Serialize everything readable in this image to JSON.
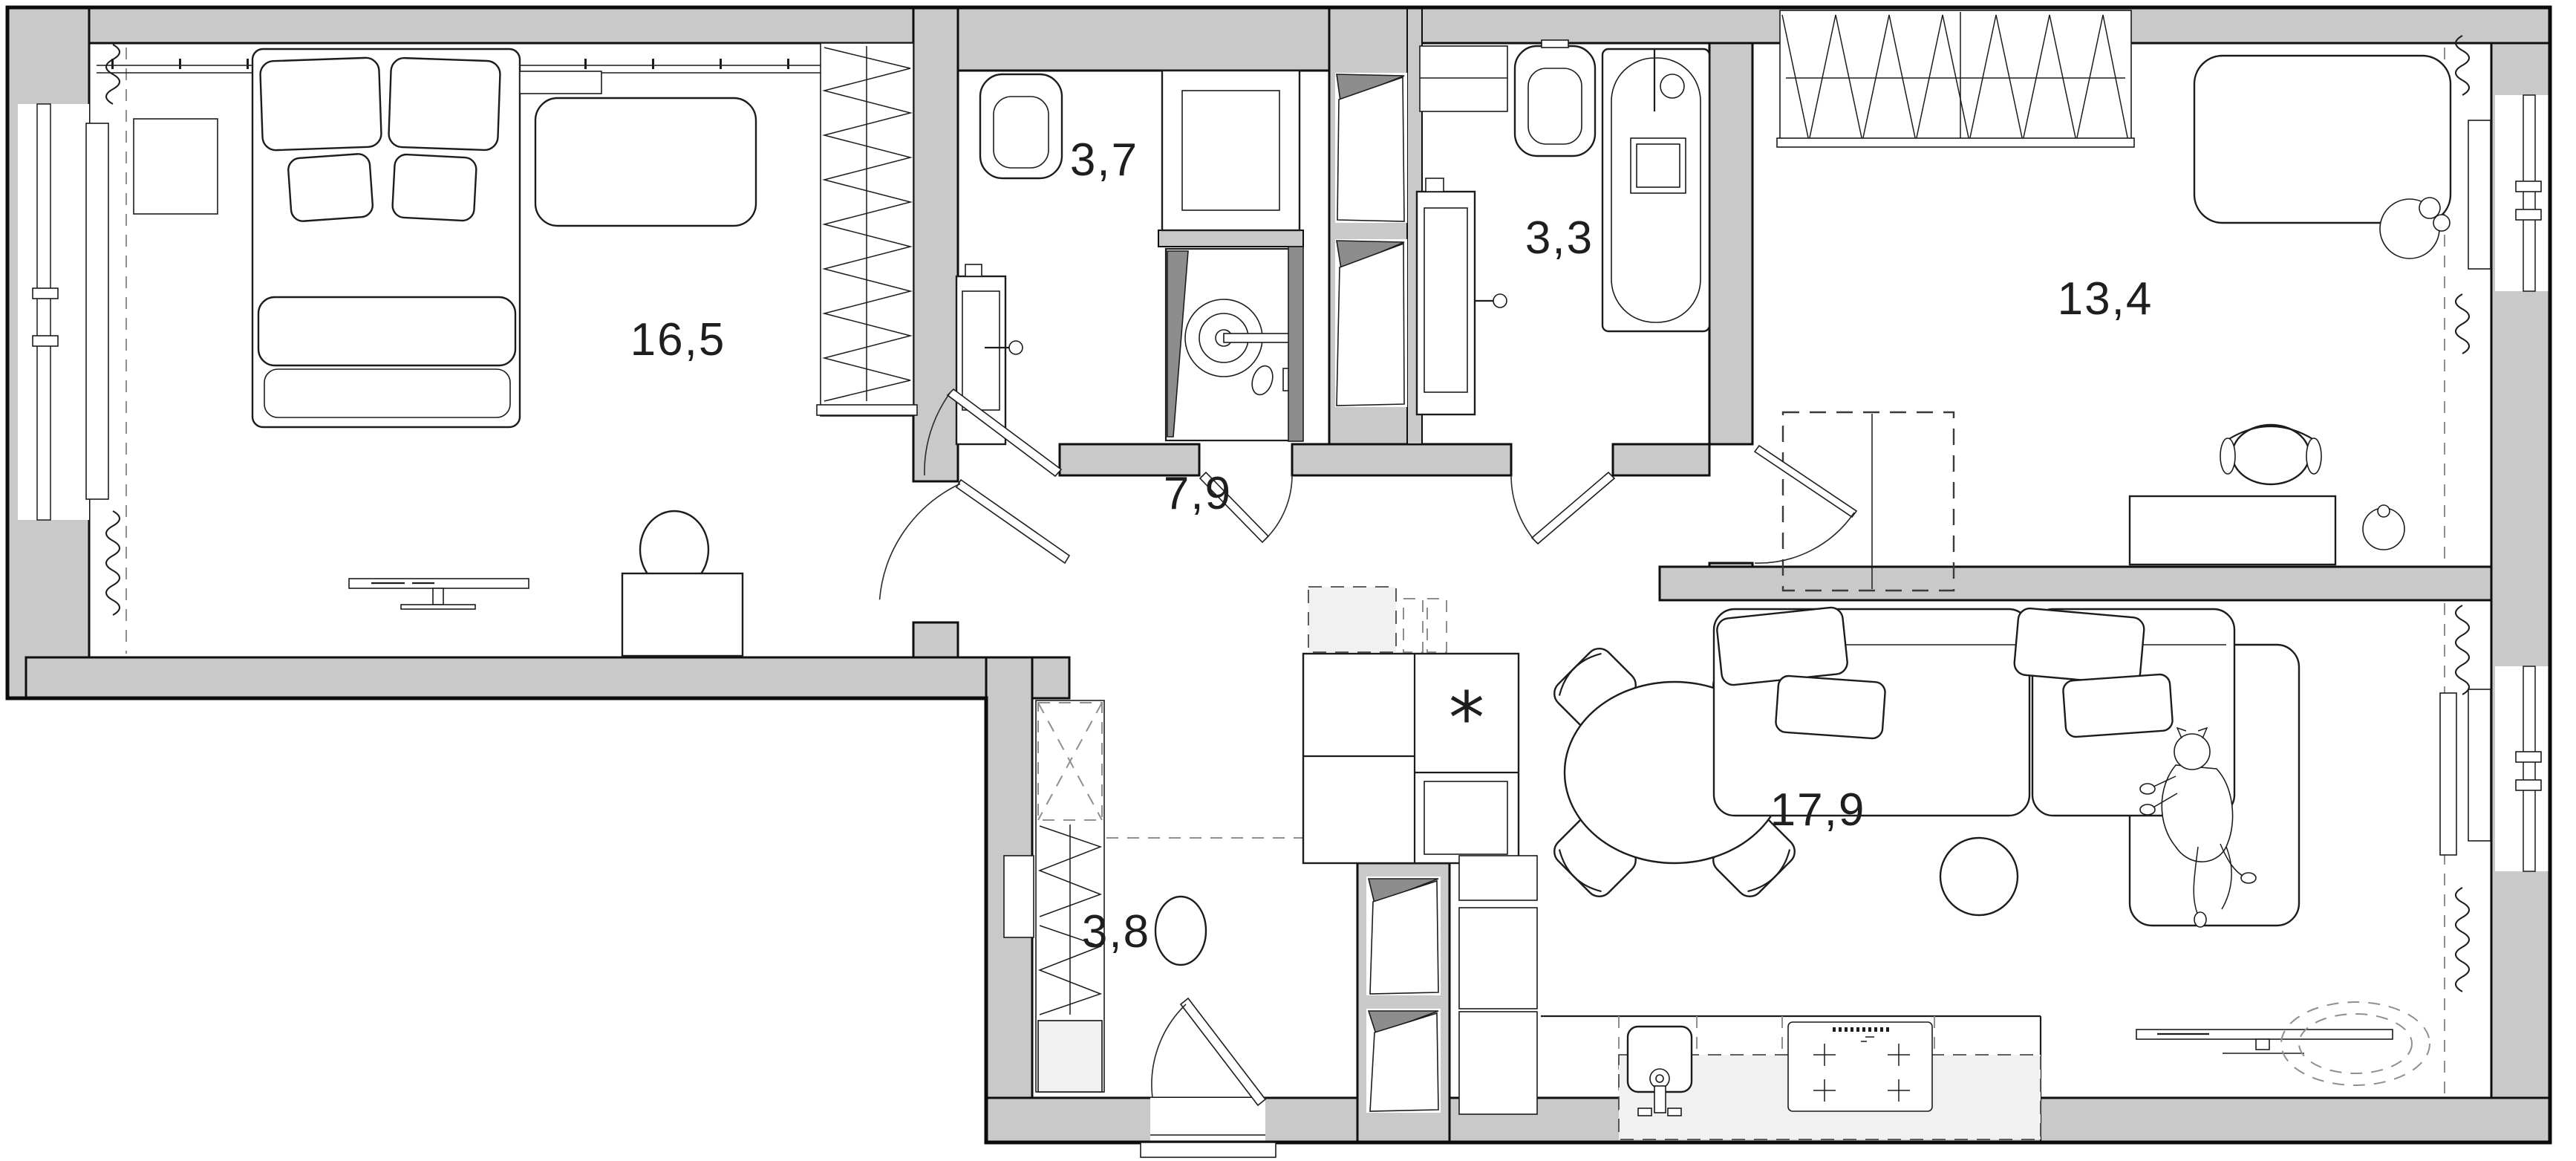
{
  "plan": {
    "type": "apartment-floor-plan",
    "rooms": [
      {
        "name": "bedroom",
        "area": "16,5"
      },
      {
        "name": "bathroom-shower",
        "area": "3,7"
      },
      {
        "name": "bathroom-tub",
        "area": "3,3"
      },
      {
        "name": "room-study",
        "area": "13,4"
      },
      {
        "name": "hallway",
        "area": "7,9"
      },
      {
        "name": "entry-corridor",
        "area": "3,8"
      },
      {
        "name": "living-kitchen",
        "area": "17,9"
      }
    ],
    "symbols": {
      "kitchen_unit_marker": "*"
    },
    "colors": {
      "wall": "#c9c9c9",
      "open_door_panel": "#8d8d8d",
      "light_fill": "#f1f1f1",
      "line": "#1c1c1c",
      "dash": "#8f8f8f",
      "background": "#ffffff"
    }
  }
}
